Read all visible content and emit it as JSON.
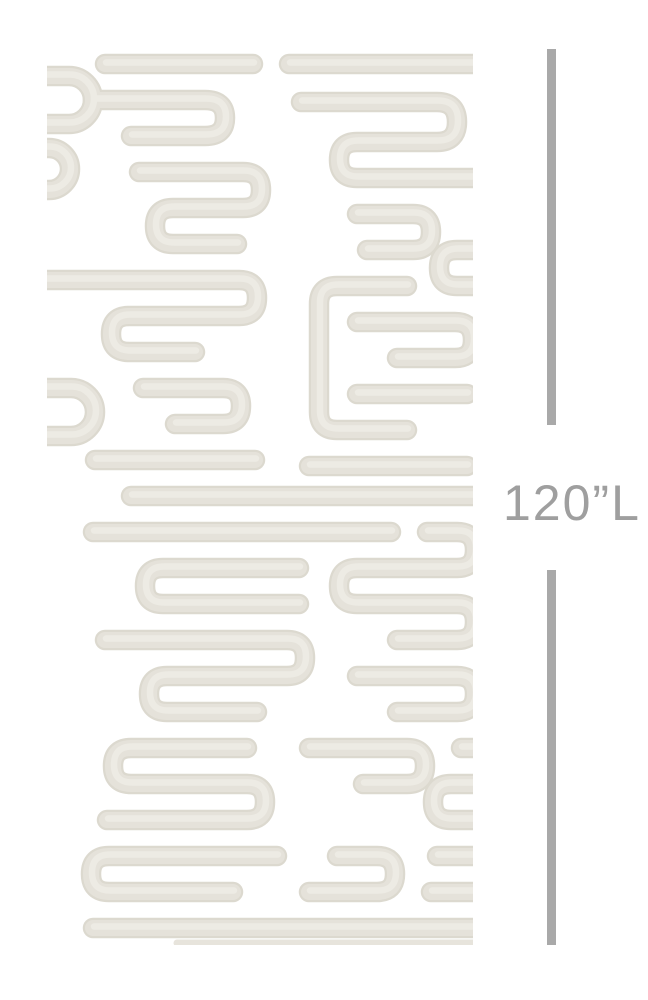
{
  "page": {
    "background_color": "#ffffff",
    "description": "wallpaper panel dimension illustration"
  },
  "panel": {
    "pattern_name": "abstract-maze-brushstroke-pattern",
    "pattern_stroke_color": "#e3e0d8",
    "pattern_stroke_edge_color": "#dcd9cf",
    "pattern_highlight_color": "#edebe4",
    "background_color": "#ffffff"
  },
  "measurement": {
    "label": "120”L",
    "line_color": "#a9a9a9",
    "text_color": "#9f9f9f"
  }
}
